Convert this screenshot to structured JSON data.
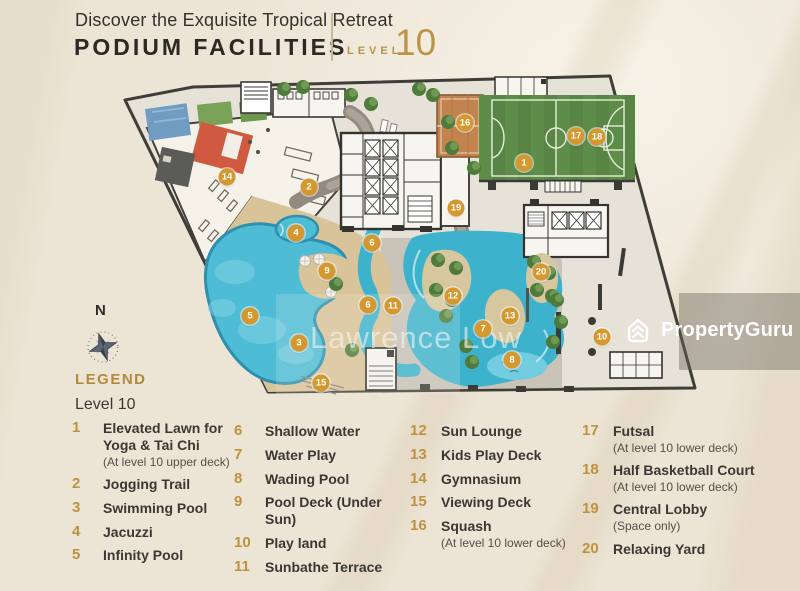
{
  "header": {
    "tagline": "Discover the Exquisite Tropical Retreat",
    "title": "PODIUM FACILITIES",
    "level_label": "LEVEL",
    "level_number": "10"
  },
  "compass": {
    "north_label": "N"
  },
  "legend": {
    "heading": "LEGEND",
    "subheading": "Level 10",
    "columns": [
      [
        {
          "num": "1",
          "label": "Elevated Lawn for Yoga & Tai Chi",
          "note": "(At level 10 upper deck)"
        },
        {
          "num": "2",
          "label": "Jogging Trail"
        },
        {
          "num": "3",
          "label": "Swimming Pool"
        },
        {
          "num": "4",
          "label": "Jacuzzi"
        },
        {
          "num": "5",
          "label": "Infinity Pool"
        }
      ],
      [
        {
          "num": "6",
          "label": "Shallow Water"
        },
        {
          "num": "7",
          "label": "Water Play"
        },
        {
          "num": "8",
          "label": "Wading Pool"
        },
        {
          "num": "9",
          "label": "Pool Deck (Under Sun)"
        },
        {
          "num": "10",
          "label": "Play land"
        },
        {
          "num": "11",
          "label": "Sunbathe Terrace"
        }
      ],
      [
        {
          "num": "12",
          "label": "Sun Lounge"
        },
        {
          "num": "13",
          "label": "Kids Play Deck"
        },
        {
          "num": "14",
          "label": "Gymnasium"
        },
        {
          "num": "15",
          "label": "Viewing Deck"
        },
        {
          "num": "16",
          "label": "Squash",
          "note": "(At level 10 lower deck)"
        }
      ],
      [
        {
          "num": "17",
          "label": "Futsal",
          "note": "(At level 10 lower deck)"
        },
        {
          "num": "18",
          "label": "Half Basketball Court",
          "note": "(At level 10 lower deck)"
        },
        {
          "num": "19",
          "label": "Central Lobby",
          "note": "(Space only)"
        },
        {
          "num": "20",
          "label": "Relaxing Yard"
        }
      ]
    ]
  },
  "map": {
    "markers": [
      {
        "n": "1",
        "x": 524,
        "y": 163
      },
      {
        "n": "2",
        "x": 309,
        "y": 187
      },
      {
        "n": "3",
        "x": 299,
        "y": 343
      },
      {
        "n": "4",
        "x": 296,
        "y": 233
      },
      {
        "n": "5",
        "x": 250,
        "y": 316
      },
      {
        "n": "6",
        "x": 372,
        "y": 243
      },
      {
        "n": "6",
        "x": 368,
        "y": 305
      },
      {
        "n": "7",
        "x": 483,
        "y": 329
      },
      {
        "n": "8",
        "x": 512,
        "y": 360
      },
      {
        "n": "9",
        "x": 327,
        "y": 271
      },
      {
        "n": "10",
        "x": 602,
        "y": 337
      },
      {
        "n": "11",
        "x": 393,
        "y": 306
      },
      {
        "n": "12",
        "x": 453,
        "y": 296
      },
      {
        "n": "13",
        "x": 510,
        "y": 316
      },
      {
        "n": "14",
        "x": 227,
        "y": 177
      },
      {
        "n": "15",
        "x": 321,
        "y": 383
      },
      {
        "n": "16",
        "x": 465,
        "y": 123
      },
      {
        "n": "17",
        "x": 576,
        "y": 136
      },
      {
        "n": "18",
        "x": 597,
        "y": 137
      },
      {
        "n": "19",
        "x": 456,
        "y": 208
      },
      {
        "n": "20",
        "x": 541,
        "y": 272
      }
    ]
  },
  "watermarks": {
    "agent_name": "Lawrence Low",
    "brand": "PropertyGuru"
  },
  "icons": {
    "compass": "compass-rose-icon",
    "brand": "propertyguru-house-icon"
  },
  "colors": {
    "marker_gold": "#d5982f",
    "legend_gold": "#bf9240",
    "header_gold": "#bd9446",
    "pool_blue": "#4fbcd6",
    "lawn_green": "#5e8c49"
  }
}
